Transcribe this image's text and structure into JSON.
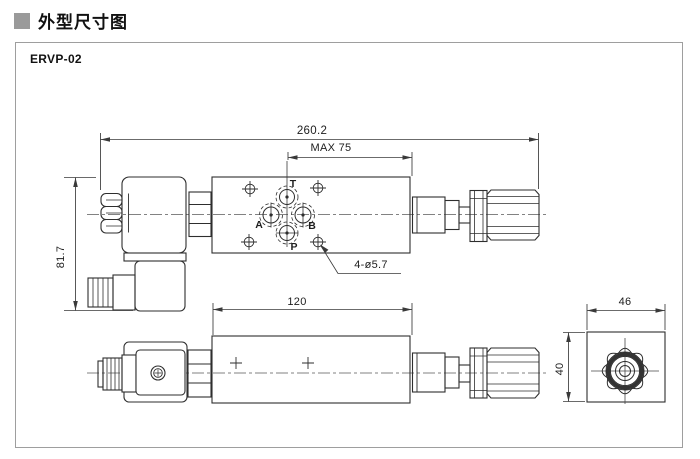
{
  "header": {
    "title": "外型尺寸图"
  },
  "model_label": "ERVP-02",
  "dimensions": {
    "overall_length": "260.2",
    "max_length": "MAX 75",
    "height": "81.7",
    "body_length": "120",
    "end_width": "46",
    "end_height": "40",
    "mounting_holes_note": "4-ø5.7"
  },
  "ports": {
    "t": "T",
    "a": "A",
    "b": "B",
    "p": "P"
  },
  "colors": {
    "section_marker": "#9a9a9a",
    "frame_border": "#9e9e9e",
    "part_line": "#2e2e2e",
    "dimension_line": "#3a3a3a"
  }
}
